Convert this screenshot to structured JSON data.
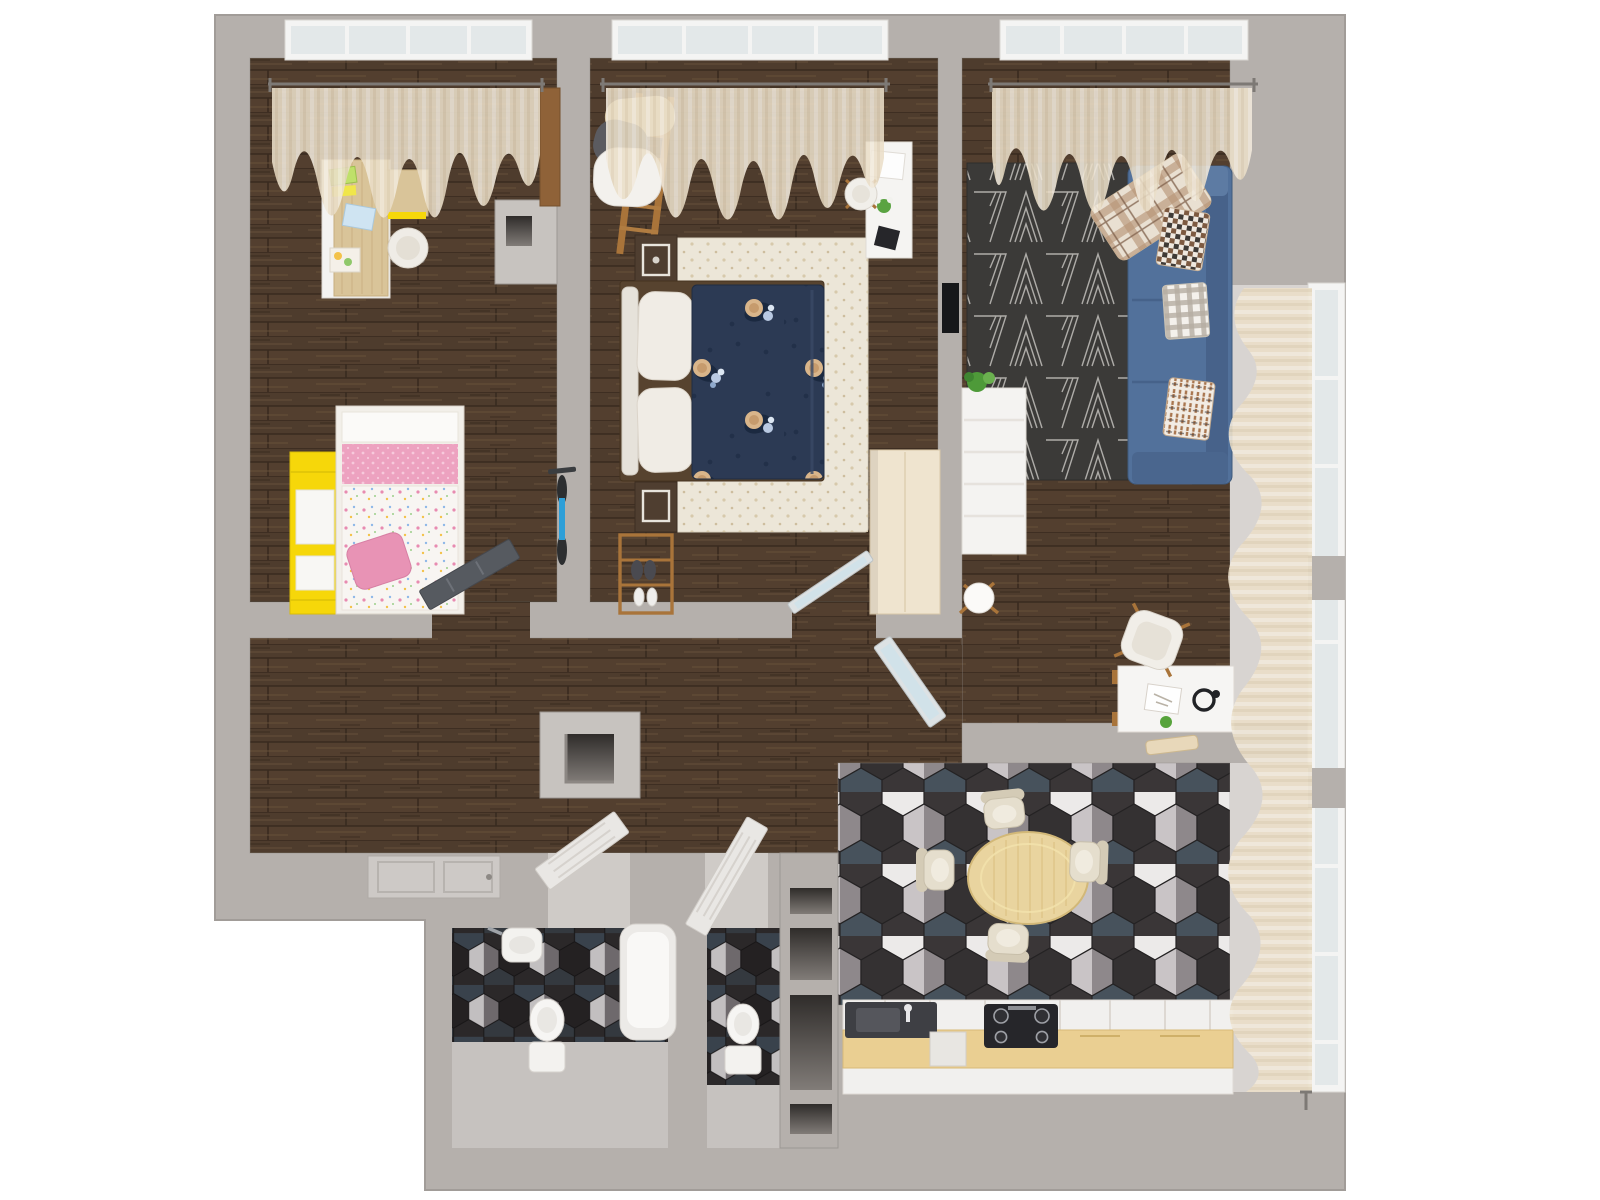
{
  "scene": {
    "type": "floor-plan-3d-render",
    "view": "top-down",
    "rooms": [
      {
        "id": "kids-bedroom",
        "floor": "dark-wood",
        "items": [
          "desk",
          "desk-cabinet",
          "office-chair",
          "papers",
          "single-bed",
          "pink-bedding",
          "floral-duvet",
          "yellow-shelving",
          "kids-bicycle",
          "wall-niche",
          "dark-room-door",
          "window-curtain"
        ]
      },
      {
        "id": "master-bedroom",
        "floor": "dark-wood",
        "items": [
          "double-bed",
          "tufted-headboard",
          "pillows",
          "navy-floral-duvet",
          "cream-rug",
          "nightstand-top",
          "nightstand-bottom",
          "ladder-clothes-rack",
          "shoe-rack",
          "wardrobe",
          "vanity-desk",
          "vanity-chair",
          "glass-door",
          "window-curtain"
        ]
      },
      {
        "id": "living-room",
        "floor": "dark-wood",
        "items": [
          "geometric-rug",
          "blue-sofa",
          "plaid-blanket",
          "throw-pillows",
          "tv",
          "bookshelf",
          "plant",
          "floor-lamp",
          "work-desk",
          "desk-chair",
          "glass-door",
          "window-curtain",
          "side-curtain"
        ]
      },
      {
        "id": "hallway",
        "floor": "dark-wood",
        "items": [
          "structural-column",
          "entrance-door",
          "bathroom-door",
          "wc-door"
        ]
      },
      {
        "id": "kitchen-dining",
        "floor": "hex-tile",
        "items": [
          "dining-table",
          "dining-chairs",
          "kitchen-counter",
          "gas-stove",
          "kitchen-sink",
          "dishwasher",
          "window-curtain"
        ]
      },
      {
        "id": "bathroom",
        "floor": "hex-tile",
        "items": [
          "washbasin",
          "toilet",
          "bathtub"
        ]
      },
      {
        "id": "wc",
        "floor": "hex-tile",
        "items": [
          "toilet"
        ]
      },
      {
        "id": "utility-shaft",
        "floor": "none",
        "items": [
          "niches"
        ]
      }
    ]
  },
  "palette": {
    "outside": "#ffffff",
    "wall": "#b5b0ac",
    "wall_light": "#c7c3bf",
    "wall_shadow": "#9c9793",
    "bay_floor": "#d8d4d1",
    "curtain": "#ebdfc9",
    "rod": "#7d7975",
    "window_glass": "#e3e8e9",
    "window_frame": "#f4f4f3",
    "kids_pink": "#eda2c0",
    "kids_pillow_pink": "#e893b5",
    "kids_yellow": "#f6d70a",
    "desk_wood": "#d9c499",
    "navy_duvet": "#2c3a54",
    "headboard_cream": "#e6e2da",
    "rug_cream": "#ece6d8",
    "dark_wood_furniture": "#4f3e30",
    "bed_frame_wood": "#57432f",
    "ladder_wood": "#a9743a",
    "wardrobe_wood": "#efe4cf",
    "rug_dark": "#3b3a38",
    "sofa_blue": "#52719b",
    "sofa_blue_dark": "#47628a",
    "white_furniture": "#f4f3f1",
    "table_wood": "#e9d49f",
    "chair_cream": "#e5decd",
    "counter_white": "#f1f0ee",
    "counter_wood": "#eacf92",
    "stove_black": "#26262a",
    "sink_dark": "#3e3f44",
    "fixture_white": "#f3f2ef",
    "door_dark": "#565a60",
    "door_white": "#e9e7e4",
    "glass_tint": "#cfe2ea",
    "tv_black": "#17181a",
    "plant_green": "#4e9a39",
    "bicycle_blue": "#2e9fd8"
  }
}
